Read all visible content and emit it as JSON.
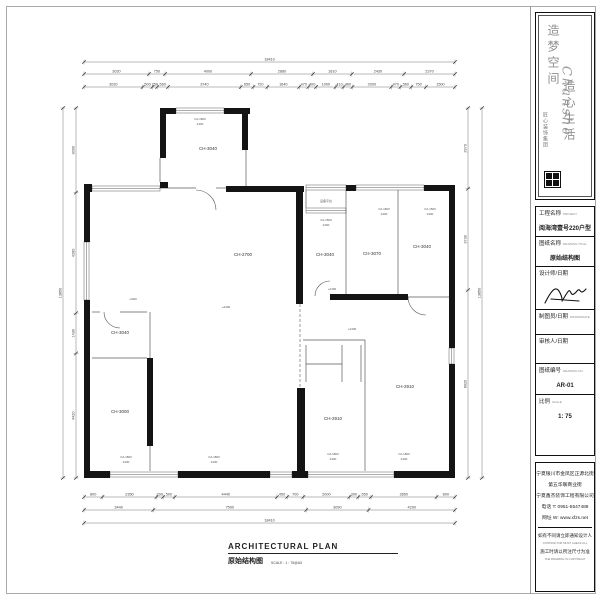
{
  "colors": {
    "wall": "#141414",
    "line": "#5a5a5a",
    "dim": "#777777",
    "dim_text": "#444444",
    "accent": "#111111"
  },
  "logo": {
    "brand": "Chanshe",
    "script_col1": "造梦空间",
    "script_col2": "造心生活",
    "tagline": "匠心装饰集团"
  },
  "title_block": {
    "project_label": "工程名称",
    "project_label_en": "PROJECT",
    "project_value": "阅海湾壹号220户型图",
    "drawing_label": "图纸名称",
    "drawing_label_en": "DRAWING TITLE",
    "drawing_value": "原始结构图",
    "designer_label": "设计师/日期",
    "designer_label_en": "DESIGNER/DATE",
    "drafter_label": "制图员/日期",
    "drafter_label_en": "DRAWN/DATE",
    "approver_label": "审核人/日期",
    "approver_label_en": "APPROVED/DATE",
    "number_label": "图纸编号",
    "number_label_en": "DRAWING NO.",
    "number_value": "AR-01",
    "scale_label": "比例",
    "scale_label_en": "SCALE",
    "scale_value": "1: 75"
  },
  "footer_block": {
    "address1": "宁夏银川市金凤区正源北街",
    "address2": "第五华联商业街",
    "company": "宁夏鑫杰装饰工程有限公司",
    "phone": "电话 T: 0951-5547488",
    "website": "网址 W: www.xfzs.net",
    "note1_cn": "如有不同请立即通知设计人员",
    "note1_en": "CONTRACTOR MUST CHECK ALL DIMENSIONS ON SITE",
    "note2_cn": "施工时请以所注尺寸为准",
    "note2_en": "THE DRAWING IS COPYRIGHT"
  },
  "plan_caption": {
    "title_en": "ARCHITECTURAL PLAN",
    "title_cn": "原始结构图",
    "scale_note": "SCALE : 1 : 75@A3"
  },
  "plan": {
    "walls": [
      [
        160,
        108,
        16,
        6
      ],
      [
        224,
        108,
        26,
        6
      ],
      [
        160,
        108,
        6,
        50
      ],
      [
        242,
        108,
        6,
        42
      ],
      [
        226,
        186,
        78,
        6
      ],
      [
        346,
        185,
        10,
        6
      ],
      [
        424,
        185,
        31,
        6
      ],
      [
        84,
        184,
        8,
        8
      ],
      [
        84,
        192,
        6,
        50
      ],
      [
        84,
        300,
        6,
        178
      ],
      [
        84,
        471,
        26,
        7
      ],
      [
        178,
        471,
        92,
        7
      ],
      [
        292,
        471,
        16,
        7
      ],
      [
        394,
        471,
        61,
        7
      ],
      [
        449,
        186,
        6,
        162
      ],
      [
        449,
        364,
        6,
        114
      ],
      [
        296,
        192,
        7,
        112
      ],
      [
        297,
        388,
        8,
        85
      ],
      [
        330,
        294,
        78,
        6
      ],
      [
        147,
        358,
        6,
        88
      ],
      [
        160,
        182,
        8,
        6
      ]
    ],
    "windows": [
      [
        176,
        108,
        48,
        5
      ],
      [
        92,
        186,
        68,
        5
      ],
      [
        306,
        185,
        40,
        5
      ],
      [
        356,
        185,
        68,
        5
      ],
      [
        84,
        242,
        5,
        58
      ],
      [
        449,
        348,
        5,
        16
      ],
      [
        110,
        472,
        68,
        5
      ],
      [
        270,
        472,
        22,
        5
      ],
      [
        308,
        472,
        86,
        5
      ],
      [
        306,
        208,
        40,
        5
      ]
    ],
    "lines": [
      [
        246,
        150,
        246,
        186
      ],
      [
        160,
        158,
        160,
        182
      ],
      [
        160,
        188,
        196,
        188
      ],
      [
        216,
        188,
        226,
        188
      ],
      [
        306,
        190,
        306,
        208
      ],
      [
        346,
        190,
        346,
        213
      ],
      [
        346,
        213,
        346,
        294
      ],
      [
        398,
        190,
        398,
        294
      ],
      [
        365,
        340,
        365,
        471
      ],
      [
        303,
        340,
        365,
        340
      ],
      [
        306,
        345,
        306,
        382
      ],
      [
        342,
        345,
        342,
        382
      ],
      [
        306,
        364,
        342,
        364
      ],
      [
        361,
        345,
        361,
        382
      ],
      [
        92,
        312,
        100,
        312
      ],
      [
        120,
        312,
        147,
        312
      ],
      [
        92,
        358,
        147,
        358
      ],
      [
        150,
        312,
        150,
        358
      ],
      [
        150,
        446,
        150,
        471
      ],
      [
        408,
        297,
        449,
        297
      ]
    ],
    "dashed": [
      [
        300,
        304,
        300,
        388
      ]
    ],
    "arcs": [
      "M104 312 A16 16 0 0 0 120 328",
      "M196 190 A20 20 0 0 1 216 210",
      "M315 296 A15 15 0 0 1 330 281",
      "M408 297 A18 18 0 0 0 426 315"
    ],
    "rooms": [
      [
        "CH-3040",
        208,
        150
      ],
      [
        "CH-2700",
        243,
        256
      ],
      [
        "CH-3040",
        325,
        256
      ],
      [
        "CH-3070",
        372,
        255
      ],
      [
        "CH-3040",
        422,
        248
      ],
      [
        "CH-3040",
        120,
        334
      ],
      [
        "CH-3000",
        120,
        413
      ],
      [
        "CH-2910",
        333,
        420
      ],
      [
        "CH-2910",
        405,
        388
      ]
    ],
    "annotations": [
      [
        "设备平台",
        326,
        202
      ],
      [
        "C2-1800",
        200,
        120
      ],
      [
        "2400",
        200,
        125
      ],
      [
        "C2-1500",
        384,
        210
      ],
      [
        "2400",
        384,
        215
      ],
      [
        "C2-1500",
        430,
        210
      ],
      [
        "2400",
        430,
        215
      ],
      [
        "C2-1500",
        326,
        221
      ],
      [
        "2400",
        326,
        226
      ],
      [
        "C2-1800",
        126,
        458
      ],
      [
        "2400",
        126,
        463
      ],
      [
        "C2-1800",
        214,
        458
      ],
      [
        "2400",
        214,
        463
      ],
      [
        "C2-1800",
        333,
        455
      ],
      [
        "2400",
        333,
        460
      ],
      [
        "C2-1800",
        404,
        455
      ],
      [
        "2400",
        404,
        460
      ],
      [
        "+2400",
        226,
        308
      ],
      [
        "-2400",
        133,
        300
      ],
      [
        "+2400",
        332,
        290
      ],
      [
        "+2400",
        352,
        330
      ]
    ],
    "dims": [
      {
        "axis": "h",
        "y": 62,
        "x1": 84,
        "x2": 455,
        "values": [
          18410
        ]
      },
      {
        "axis": "h",
        "y": 74,
        "x1": 84,
        "x2": 455,
        "values": [
          3020,
          750,
          4000,
          2880,
          1810,
          2430,
          2370
        ]
      },
      {
        "axis": "h",
        "y": 87,
        "x1": 84,
        "x2": 455,
        "values": [
          3020,
          500,
          250,
          560,
          3740,
          650,
          720,
          1640,
          470,
          400,
          1000,
          410,
          460,
          2000,
          470,
          560,
          750,
          1500
        ]
      },
      {
        "axis": "h",
        "y": 497,
        "x1": 84,
        "x2": 455,
        "values": [
          800,
          2350,
          290,
          500,
          4440,
          450,
          700,
          2000,
          390,
          550,
          2850,
          800
        ]
      },
      {
        "axis": "h",
        "y": 510,
        "x1": 84,
        "x2": 455,
        "values": [
          3440,
          7590,
          3090,
          4290
        ]
      },
      {
        "axis": "h",
        "y": 523,
        "x1": 84,
        "x2": 455,
        "values": [
          18410
        ]
      },
      {
        "axis": "v",
        "x": 76,
        "y1": 108,
        "y2": 478,
        "values": [
          3000,
          4280,
          1430,
          4420
        ]
      },
      {
        "axis": "v",
        "x": 63,
        "y1": 108,
        "y2": 478,
        "values": [
          13850
        ]
      },
      {
        "axis": "v",
        "x": 468,
        "y1": 108,
        "y2": 478,
        "values": [
          2970,
          3730,
          6920
        ]
      },
      {
        "axis": "v",
        "x": 482,
        "y1": 108,
        "y2": 478,
        "values": [
          13850
        ]
      }
    ]
  }
}
